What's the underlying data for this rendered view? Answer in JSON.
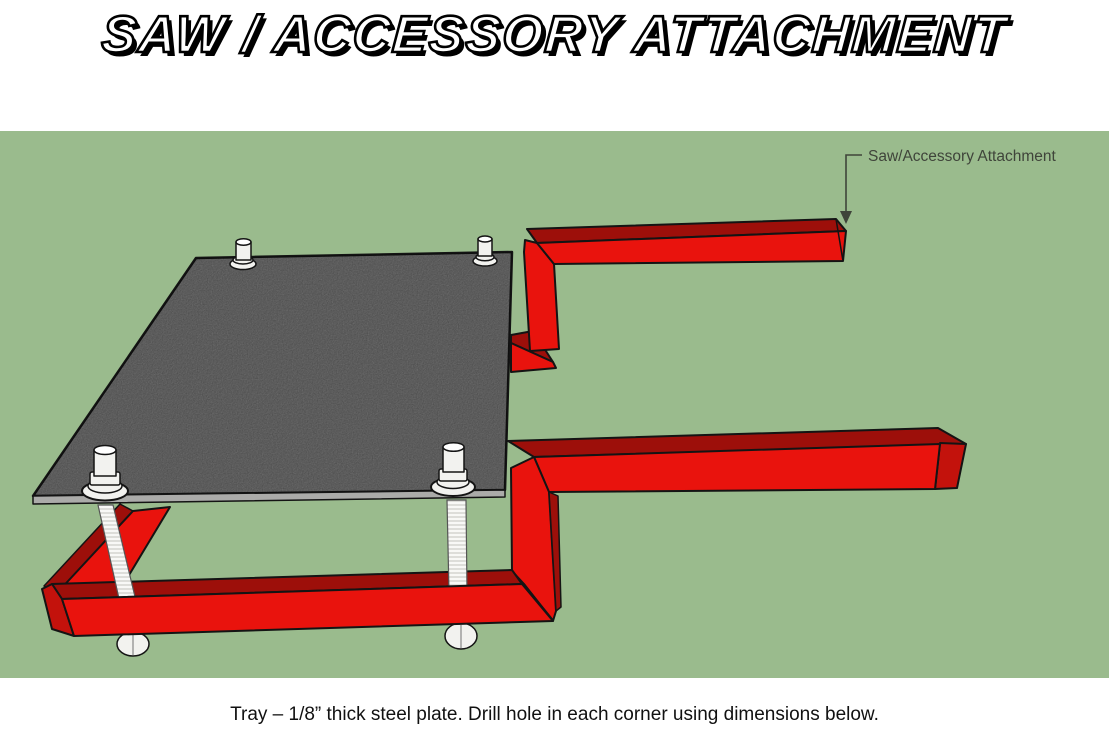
{
  "page": {
    "title": "SAW / ACCESSORY ATTACHMENT",
    "caption": "Tray – 1/8” thick steel plate. Drill hole in each corner using dimensions below."
  },
  "scene": {
    "label": "Saw/Accessory Attachment"
  },
  "colors": {
    "scene-bg": "#9ABB8D",
    "red-bright": "#E9130D",
    "red-dark": "#9D0F0A",
    "red-mid": "#C3120C",
    "steel": "#7D7D7D",
    "steel-edge": "#ABABA9",
    "bolt-fill": "#F2F2EF",
    "outline": "#141414",
    "label-text": "#3F443A",
    "caption-text": "#111111",
    "title-fill": "#FFFFFF",
    "title-outline": "#000000"
  }
}
